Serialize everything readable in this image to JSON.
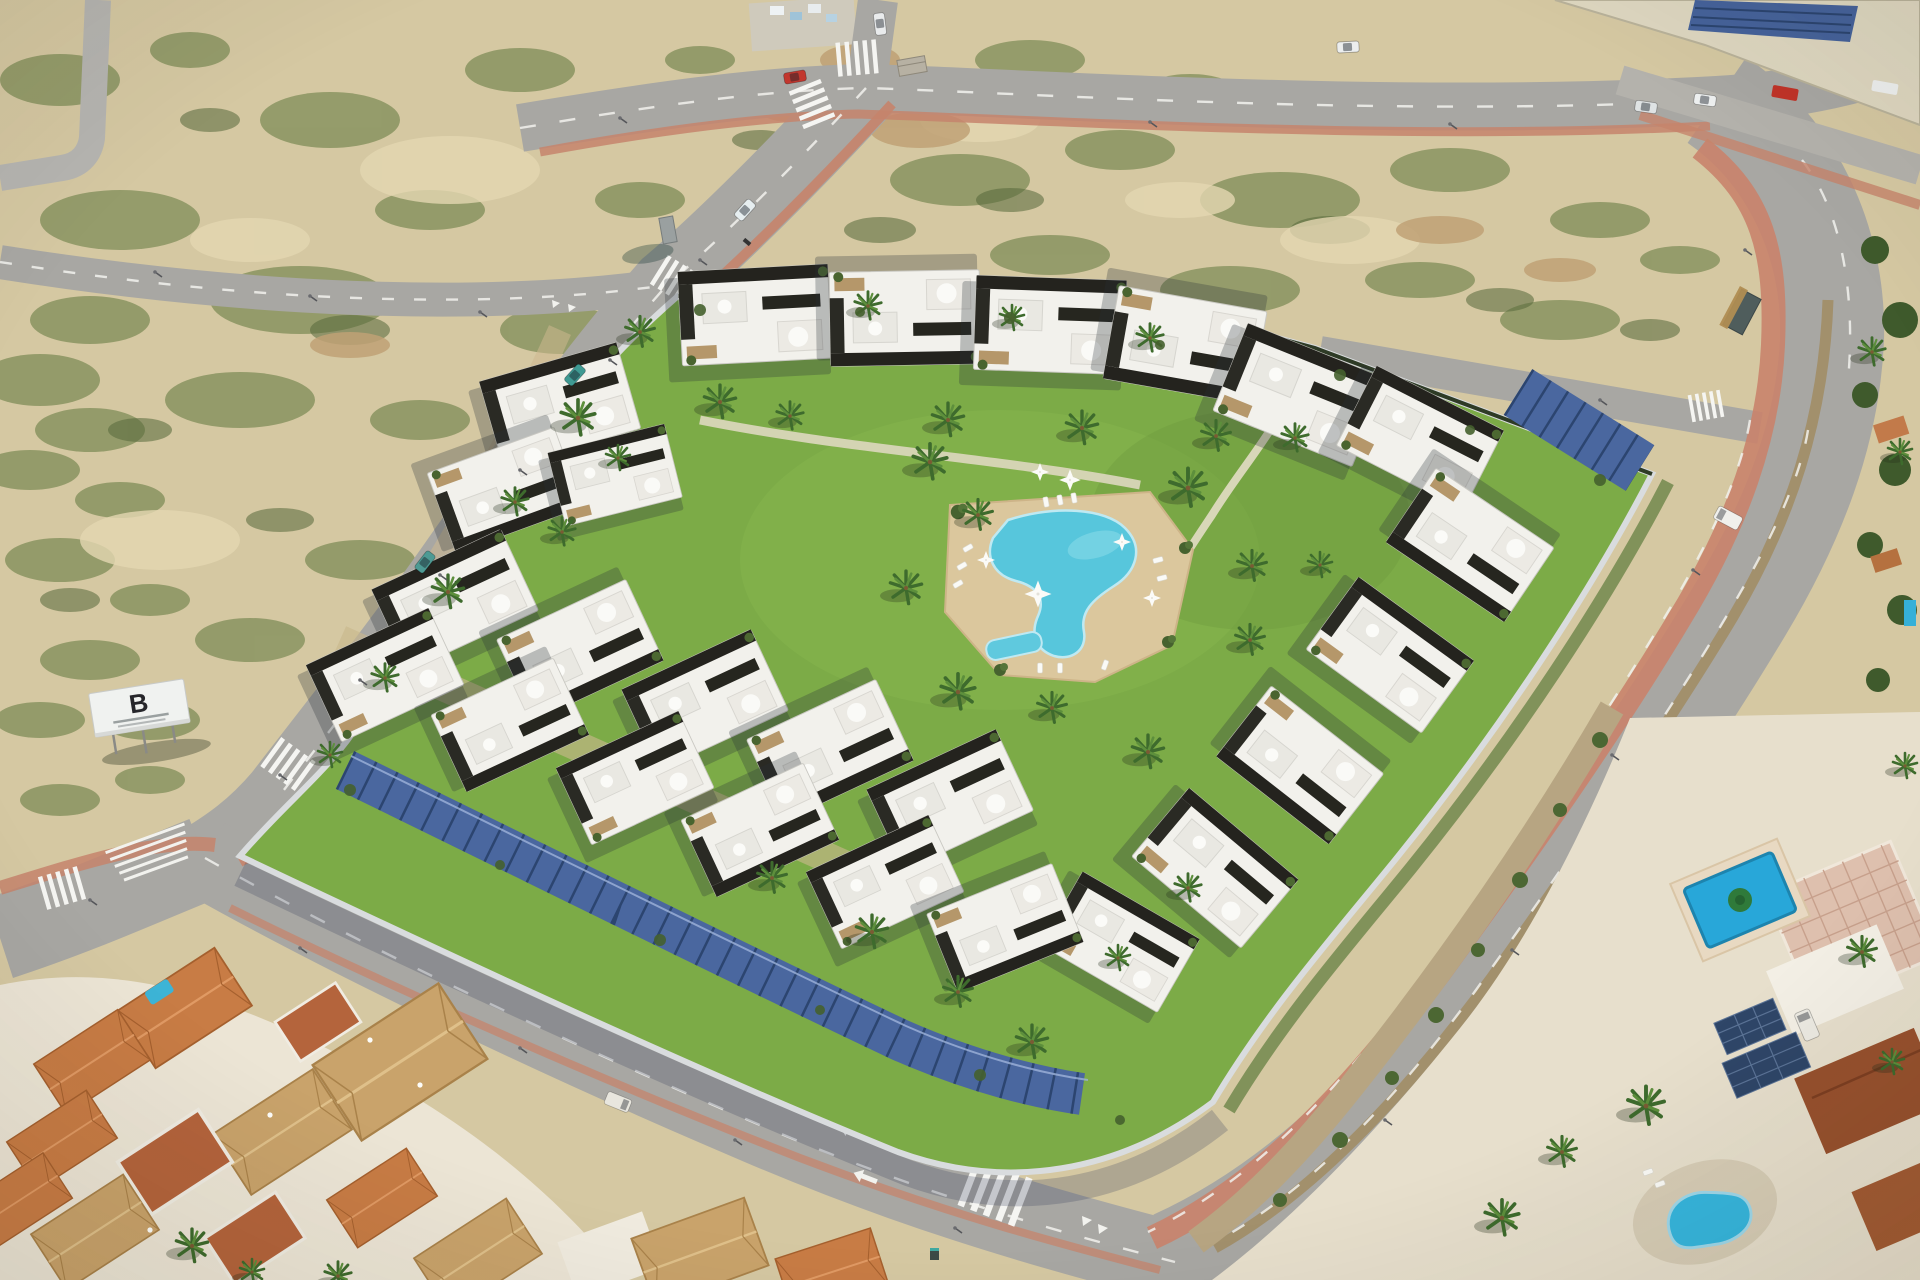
{
  "meta": {
    "description": "Aerial render of a new-build residential development with communal pool, palm gardens and solar carports, surrounded by scrubland, roads and existing Spanish villas"
  },
  "billboard": {
    "letter": "B"
  },
  "palette": {
    "sand": "#d5c8a2",
    "sand_light": "#e3d7b2",
    "scrub_green": "#6d8148",
    "scrub_dark": "#55683a",
    "asphalt": "#a8a7a3",
    "sidewalk_terracotta": "#c5846c",
    "lawn": "#7cab47",
    "pool_water": "#57c6dc",
    "villa_pool": "#2aa7d9",
    "deck": "#dbc79d",
    "building_white": "#f2f1ec",
    "building_dark": "#24231e",
    "stone": "#b5976a",
    "solar_panel": "#46639b",
    "roof_orange": "#c87c45",
    "roof_tan": "#c9a36b",
    "roof_brown": "#97512e",
    "perimeter_wall": "#d9dcde"
  },
  "scene": {
    "landmarks": [
      {
        "name": "new-development",
        "description": "Modern white townhouse complex with black roof terraces and parasols"
      },
      {
        "name": "communal-pool",
        "description": "Irregular turquoise pool with sun deck, loungers and kids pool"
      },
      {
        "name": "solar-carports",
        "description": "Photovoltaic canopies along south and east perimeter walls"
      },
      {
        "name": "scrubland",
        "description": "Undeveloped sandy plots with low green vegetation"
      },
      {
        "name": "spanish-houses",
        "description": "Existing terracotta-roof houses at the south-west"
      },
      {
        "name": "villa-compound",
        "description": "Private villas with rectangular and kidney-shaped pools and rooftop solar"
      },
      {
        "name": "industrial-warehouse",
        "description": "Warehouse with rooftop solar array at the north-east"
      },
      {
        "name": "billboard",
        "description": "White development sign on posts"
      }
    ],
    "vehicles": [
      {
        "name": "red-car",
        "location": "top road"
      },
      {
        "name": "white-car",
        "location": "north junction"
      },
      {
        "name": "teal-car",
        "location": "west road"
      },
      {
        "name": "white-van",
        "location": "east avenue"
      },
      {
        "name": "minivan",
        "location": "south road"
      },
      {
        "name": "red-truck",
        "location": "industrial yard"
      }
    ]
  }
}
